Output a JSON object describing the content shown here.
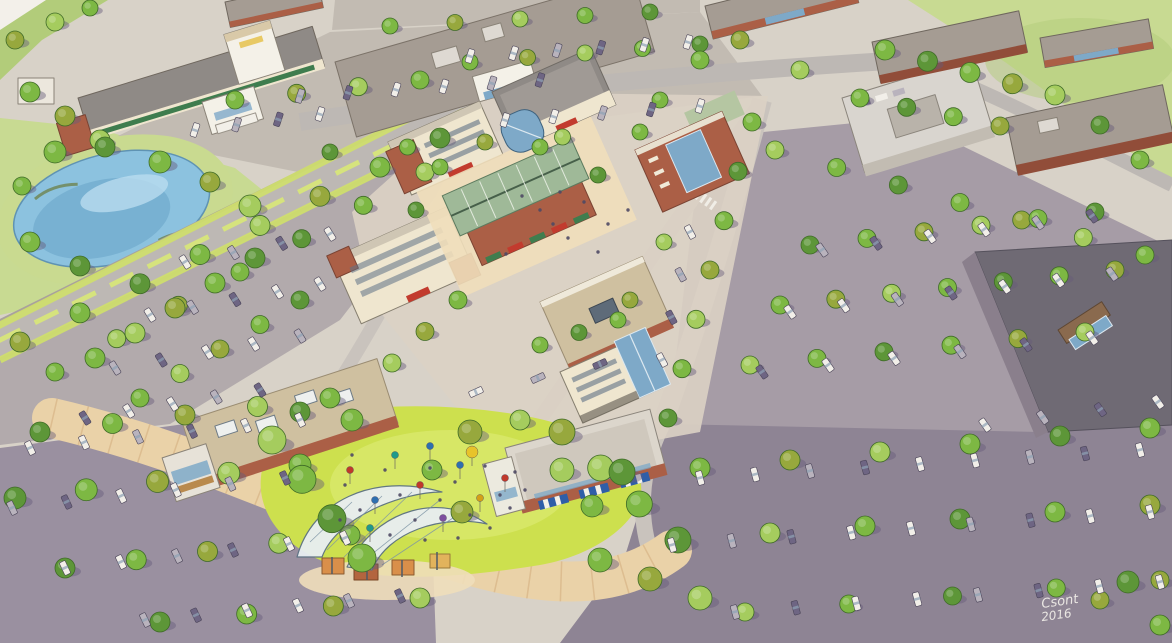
{
  "signature": {
    "artist": "Csont",
    "year": "2016"
  },
  "colors": {
    "paper": "#d8d2c8",
    "paper_edge": "#f3f0ea",
    "grass": "#b2cc7a",
    "grass_light": "#c8da92",
    "lawn": "#cde04e",
    "lawn_light": "#e0ec7a",
    "pond": "#8cc2df",
    "pond_deep": "#6fa9cc",
    "pond_hl": "#b9dcef",
    "bank": "#c9da90",
    "road": "#bdb8b4",
    "road_light": "#c9c3bd",
    "asphalt_tl": "#c2bbb2",
    "asphalt_left": "#b2aaac",
    "asphalt_bl": "#9a90a0",
    "asphalt_br": "#8e8494",
    "asphalt_r": "#a69ca6",
    "median": "#d6e37d",
    "island": "#cfe06a",
    "tree_green": "#7db843",
    "tree_olive": "#97a83d",
    "tree_light": "#a5cc5e",
    "tree_deep": "#5d9638",
    "tree_stroke": "#3f6b28",
    "shadow": "#655c7a",
    "brick": "#ab5f46",
    "brick_dark": "#914d39",
    "cream": "#efe6cf",
    "white_wall": "#f4f1e8",
    "tan_wall": "#d9c9a8",
    "glass": "#7ea9c8",
    "glass_dark": "#55809f",
    "win": "#5f7186",
    "roof_taupe": "#a59c93",
    "roof_gray": "#8f8a86",
    "roof_dark": "#6f6a74",
    "roof_green": "#9fb998",
    "roof_green2": "#b5c6a2",
    "roof_tan": "#cfc0a0",
    "roof_light": "#dcd6cc",
    "wall_purple": "#8a7f8c",
    "awning_red": "#c23b2e",
    "awning_green": "#3f7d4e",
    "awning_blue": "#2f5ea8",
    "awning_tan": "#b98a4e",
    "car_white": "#f2efe9",
    "car_gray": "#b9b3bd",
    "car_dark": "#6e6583",
    "car_stroke": "#4a4458",
    "plaza": "#ead2a8",
    "plaza_seam": "#cfa877",
    "plaza_light": "#f0deba",
    "paving": "#dcd2c4",
    "crowd": "#4e4964",
    "sign_white": "#f5f2ec",
    "kiosk1": "#d98f4a",
    "kiosk2": "#b3653f",
    "kiosk3": "#e2b35c",
    "canopy_glass": "#e8eef2"
  },
  "scene": {
    "tree_rows": [
      [
        390,
        26,
        650,
        12,
        5,
        8
      ],
      [
        470,
        62,
        700,
        44,
        5,
        8
      ],
      [
        235,
        100,
        420,
        80,
        4,
        9
      ],
      [
        440,
        138,
        20,
        342,
        8,
        10
      ],
      [
        425,
        172,
        55,
        372,
        7,
        9
      ],
      [
        330,
        152,
        640,
        132,
        5,
        8
      ],
      [
        255,
        258,
        95,
        358,
        5,
        10
      ],
      [
        300,
        300,
        140,
        398,
        5,
        9
      ],
      [
        40,
        432,
        330,
        398,
        5,
        10
      ],
      [
        15,
        498,
        300,
        465,
        5,
        11
      ],
      [
        65,
        568,
        350,
        535,
        5,
        10
      ],
      [
        160,
        622,
        420,
        598,
        4,
        10
      ],
      [
        885,
        50,
        1055,
        95,
        5,
        10
      ],
      [
        860,
        98,
        1000,
        126,
        4,
        9
      ],
      [
        775,
        150,
        1145,
        255,
        7,
        9
      ],
      [
        810,
        245,
        1095,
        212,
        6,
        9
      ],
      [
        780,
        305,
        1115,
        270,
        7,
        9
      ],
      [
        750,
        365,
        1085,
        332,
        6,
        9
      ],
      [
        752,
        122,
        668,
        418,
        7,
        9
      ],
      [
        700,
        468,
        1150,
        428,
        6,
        10
      ],
      [
        675,
        540,
        1150,
        505,
        6,
        10
      ],
      [
        745,
        612,
        1160,
        580,
        5,
        9
      ],
      [
        272,
        440,
        362,
        558,
        4,
        14
      ],
      [
        562,
        432,
        678,
        540,
        4,
        13
      ],
      [
        600,
        560,
        700,
        598,
        3,
        12
      ],
      [
        440,
        167,
        416,
        210,
        2,
        8
      ],
      [
        458,
        300,
        392,
        363,
        3,
        9
      ],
      [
        540,
        345,
        618,
        320,
        3,
        8
      ],
      [
        630,
        300,
        664,
        242,
        2,
        8
      ],
      [
        540,
        147,
        598,
        175,
        2,
        8
      ],
      [
        30,
        92,
        100,
        140,
        3,
        10
      ]
    ],
    "trees": [
      [
        55,
        152,
        11
      ],
      [
        105,
        147,
        10
      ],
      [
        160,
        162,
        11
      ],
      [
        210,
        182,
        10
      ],
      [
        250,
        206,
        11
      ],
      [
        30,
        242,
        10
      ],
      [
        80,
        266,
        10
      ],
      [
        22,
        186,
        9
      ],
      [
        470,
        432,
        12
      ],
      [
        520,
        420,
        10
      ],
      [
        352,
        420,
        11
      ],
      [
        300,
        412,
        10
      ],
      [
        432,
        470,
        10
      ],
      [
        462,
        512,
        11
      ],
      [
        562,
        470,
        12
      ],
      [
        592,
        506,
        11
      ],
      [
        622,
        472,
        13
      ],
      [
        700,
        60,
        9
      ],
      [
        740,
        40,
        9
      ],
      [
        800,
        70,
        9
      ],
      [
        660,
        100,
        8
      ],
      [
        1100,
        125,
        9
      ],
      [
        1140,
        160,
        9
      ],
      [
        15,
        40,
        9
      ],
      [
        55,
        22,
        9
      ],
      [
        90,
        8,
        8
      ],
      [
        1128,
        582,
        11
      ],
      [
        1160,
        625,
        10
      ],
      [
        1100,
        600,
        9
      ]
    ],
    "car_rows": [
      [
        470,
        56,
        688,
        42,
        6,
        -72
      ],
      [
        300,
        96,
        540,
        80,
        6,
        -72
      ],
      [
        505,
        120,
        700,
        106,
        5,
        -72
      ],
      [
        195,
        130,
        320,
        114,
        4,
        -72
      ],
      [
        185,
        262,
        330,
        234,
        4,
        58
      ],
      [
        150,
        315,
        320,
        284,
        5,
        58
      ],
      [
        115,
        368,
        300,
        336,
        5,
        58
      ],
      [
        85,
        418,
        260,
        390,
        5,
        58
      ],
      [
        30,
        448,
        300,
        420,
        6,
        65
      ],
      [
        12,
        508,
        285,
        478,
        6,
        65
      ],
      [
        65,
        568,
        345,
        538,
        6,
        65
      ],
      [
        145,
        620,
        400,
        596,
        6,
        65
      ],
      [
        700,
        478,
        1140,
        450,
        9,
        75
      ],
      [
        672,
        545,
        1150,
        512,
        9,
        75
      ],
      [
        735,
        612,
        1160,
        582,
        8,
        75
      ],
      [
        822,
        250,
        1092,
        216,
        6,
        55
      ],
      [
        790,
        312,
        1112,
        274,
        7,
        55
      ],
      [
        762,
        372,
        1092,
        338,
        6,
        55
      ],
      [
        985,
        425,
        1158,
        402,
        4,
        55
      ],
      [
        690,
        232,
        662,
        360,
        4,
        62
      ],
      [
        476,
        392,
        600,
        364,
        3,
        -24
      ]
    ],
    "balloons": [
      [
        350,
        470,
        "#c0392b",
        3.5
      ],
      [
        375,
        500,
        "#2e6fb0",
        3.5
      ],
      [
        395,
        455,
        "#1f9a8a",
        3.5
      ],
      [
        420,
        485,
        "#c0392b",
        3.5
      ],
      [
        443,
        518,
        "#7d4fa0",
        3.5
      ],
      [
        460,
        465,
        "#2e6fb0",
        3.5
      ],
      [
        480,
        498,
        "#d4a017",
        3.5
      ],
      [
        505,
        478,
        "#c0392b",
        3.5
      ],
      [
        430,
        446,
        "#2e6fb0",
        3.5
      ],
      [
        370,
        528,
        "#1f9a8a",
        3.5
      ],
      [
        472,
        452,
        "#e8c32a",
        6
      ]
    ],
    "crowd": [
      [
        345,
        485
      ],
      [
        360,
        510
      ],
      [
        385,
        470
      ],
      [
        400,
        495
      ],
      [
        415,
        520
      ],
      [
        430,
        468
      ],
      [
        440,
        500
      ],
      [
        455,
        482
      ],
      [
        470,
        515
      ],
      [
        485,
        466
      ],
      [
        500,
        495
      ],
      [
        515,
        472
      ],
      [
        352,
        455
      ],
      [
        390,
        535
      ],
      [
        425,
        540
      ],
      [
        458,
        538
      ],
      [
        490,
        528
      ],
      [
        510,
        508
      ],
      [
        525,
        490
      ],
      [
        340,
        520
      ],
      [
        540,
        210
      ],
      [
        553,
        224
      ],
      [
        568,
        238
      ],
      [
        584,
        202
      ],
      [
        598,
        252
      ],
      [
        522,
        196
      ],
      [
        608,
        224
      ],
      [
        506,
        254
      ],
      [
        628,
        210
      ],
      [
        560,
        192
      ]
    ]
  }
}
